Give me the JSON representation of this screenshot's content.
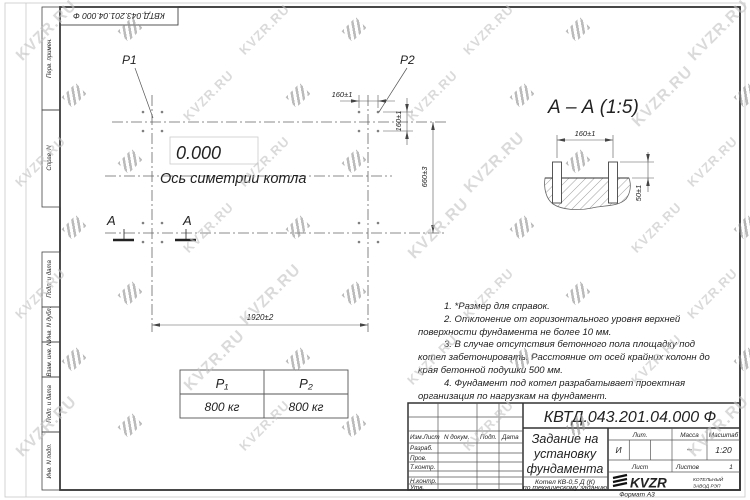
{
  "doc": {
    "number_rotated": "КВТД.043.201.04.000  Ф",
    "format_label": "Формат А3"
  },
  "watermark": {
    "text": "KVZR.RU"
  },
  "side_labels": {
    "perv_primen": "Перв. примен.",
    "sprav_n": "Справ. N",
    "podp_data_1": "Подп. и дата",
    "inv_dubl": "Инв. N дубл.",
    "vzam_inv": "Взам. инв. N",
    "podp_data_2": "Подп. и дата",
    "inv_podl": "Инв. N подл."
  },
  "plan": {
    "p1": "P1",
    "p2": "P2",
    "level": "0.000",
    "axis_label": "Ось симетрии котла",
    "section_letter": "А",
    "dim_160_h": "160±1",
    "dim_160_v": "160±1",
    "dim_660": "660±3",
    "dim_1920": "1920±2"
  },
  "section": {
    "title": "А – А (1:5)",
    "dim_160": "160±1",
    "dim_50": "50±1"
  },
  "notes": {
    "n1": "1. *Размер для справок.",
    "n2": "2. Отклонение от горизонтального уровня верхней поверхности фундамента не более 10 мм.",
    "n3": "3. В случае отсутствия бетонного пола площадку под котел забетонировать. Расстояние от осей крайних колонн до края бетонной подушки 500 мм.",
    "n4": "4. Фундамент под котел разрабатывает проектная организация по нагрузкам на фундамент."
  },
  "load_table": {
    "col1_header": "P₁",
    "col2_header": "P₂",
    "col1_value": "800 кг",
    "col2_value": "800 кг"
  },
  "title_block": {
    "doc_number": "КВТД.043.201.04.000  Ф",
    "title_lines": [
      "Задание на",
      "установку",
      "фундамента"
    ],
    "product_line1": "Котел  КВ-0,5 Д  (К)",
    "product_line2": "по техническому заданию",
    "header_cols": {
      "izm": "Изм.Лист",
      "doc": "N докум.",
      "podp": "Подп.",
      "data": "Дата"
    },
    "sign_rows": {
      "razrab": "Разраб.",
      "prov": "Пров.",
      "tkontr": "Т.контр.",
      "nkontr": "Н.контр.",
      "utv": "Утв."
    },
    "lit_label": "Лит.",
    "lit_value": "И",
    "mass_label": "Масса",
    "mass_value": "–",
    "scale_label": "Масштаб",
    "scale_value": "1:20",
    "sheet_label": "Лист",
    "sheets_label": "Листов",
    "sheets_value": "1",
    "logo": {
      "brand": "KVZR",
      "sub1": "КОТЕЛЬНЫЙ",
      "sub2": "ЗАВОД РЭП"
    }
  }
}
